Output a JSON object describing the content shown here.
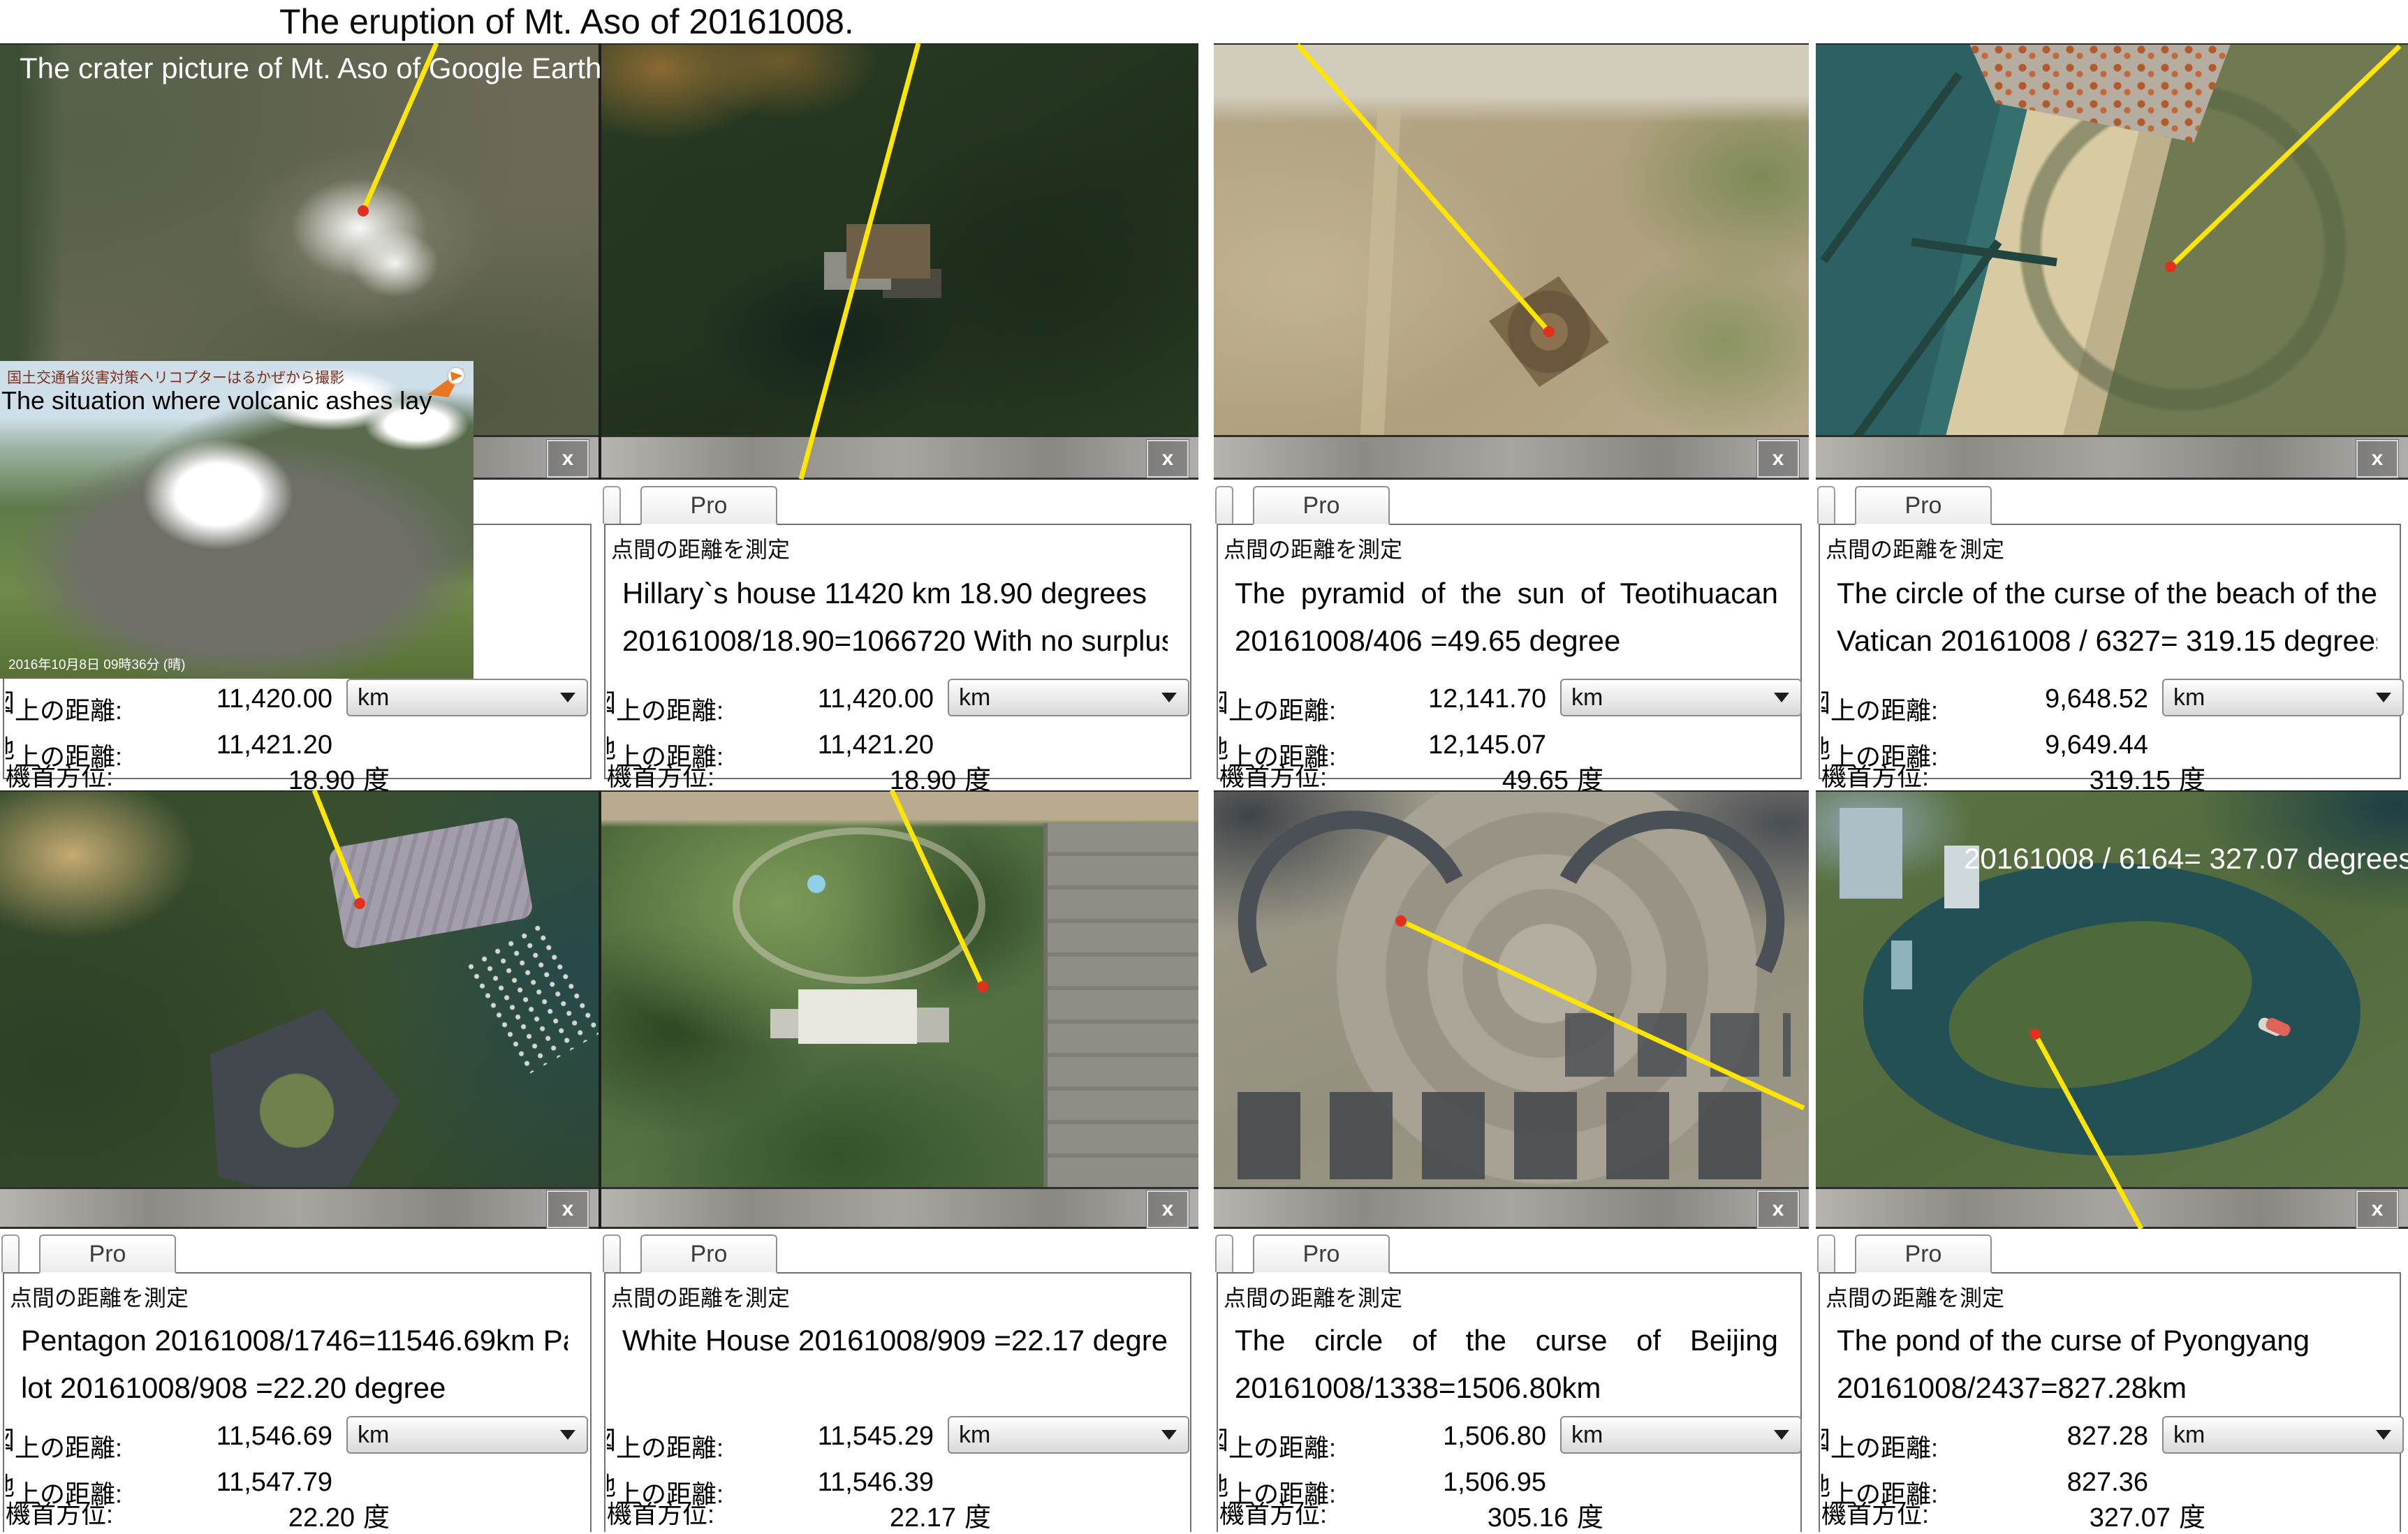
{
  "title": "The eruption of Mt. Aso of 20161008.",
  "common": {
    "pro_tab": "Pro",
    "measure_title": "点間の距離を測定",
    "map_label_fragment": "図",
    "ground_label_fragment": "地",
    "distance_label": "上の距離:",
    "heading_label": "機首方位:",
    "unit": "km",
    "degree_unit": "度",
    "close": "x"
  },
  "panels": [
    {
      "name": "mt-aso",
      "caption": "The crater picture of Mt. Aso of Google Earth",
      "inset": {
        "credit": "国土交通省災害対策ヘリコプターはるかぜから撮影",
        "caption": "The situation where volcanic ashes lay",
        "timestamp": "2016年10月8日 09時36分 (晴)"
      },
      "map_distance": "11,420.00",
      "ground_distance": "11,421.20",
      "heading": "18.90"
    },
    {
      "name": "hillarys-house",
      "desc1": "Hillary`s house   11420 km 18.90 degrees",
      "desc2": "20161008/18.90=1066720 With no surplus",
      "map_distance": "11,420.00",
      "ground_distance": "11,421.20",
      "heading": "18.90"
    },
    {
      "name": "teotihuacan",
      "desc1": "The pyramid of the sun of Teotihuacan",
      "desc2": "20161008/406 =49.65 degree",
      "map_distance": "12,141.70",
      "ground_distance": "12,145.07",
      "heading": "49.65"
    },
    {
      "name": "vatican-beach",
      "desc1": "The circle of the curse of the beach of the",
      "desc2": "Vatican 20161008 / 6327= 319.15 degrees",
      "map_distance": "9,648.52",
      "ground_distance": "9,649.44",
      "heading": "319.15"
    },
    {
      "name": "pentagon",
      "desc1": "Pentagon 20161008/1746=11546.69km Parking",
      "desc2": "lot  20161008/908 =22.20 degree",
      "map_distance": "11,546.69",
      "ground_distance": "11,547.79",
      "heading": "22.20"
    },
    {
      "name": "white-house",
      "desc1": "White House  20161008/909 =22.17 degree",
      "desc2": "",
      "map_distance": "11,545.29",
      "ground_distance": "11,546.39",
      "heading": "22.17"
    },
    {
      "name": "beijing",
      "desc1": "The circle of the curse of Beijing",
      "desc2": "20161008/1338=1506.80km",
      "map_distance": "1,506.80",
      "ground_distance": "1,506.95",
      "heading": "305.16"
    },
    {
      "name": "pyongyang",
      "desc1": "The pond of the curse of Pyongyang",
      "desc2": "20161008/2437=827.28km",
      "overlay": "20161008 / 6164= 327.07 degrees",
      "map_distance": "827.28",
      "ground_distance": "827.36",
      "heading": "327.07"
    }
  ]
}
